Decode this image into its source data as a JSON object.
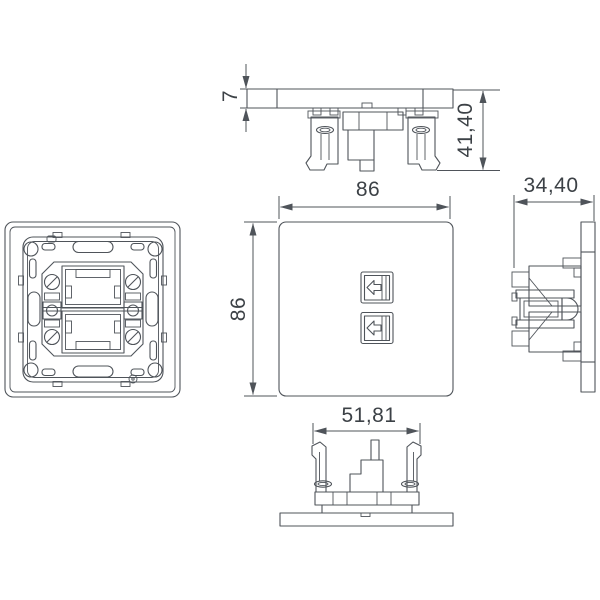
{
  "dimensions": {
    "plate_thickness": "7",
    "total_depth": "41,40",
    "plate_width": "86",
    "plate_height": "86",
    "side_depth": "34,40",
    "mechanism_width": "51,81"
  },
  "colors": {
    "line": "#4f545a",
    "text": "#3c4146",
    "background": "#ffffff"
  }
}
